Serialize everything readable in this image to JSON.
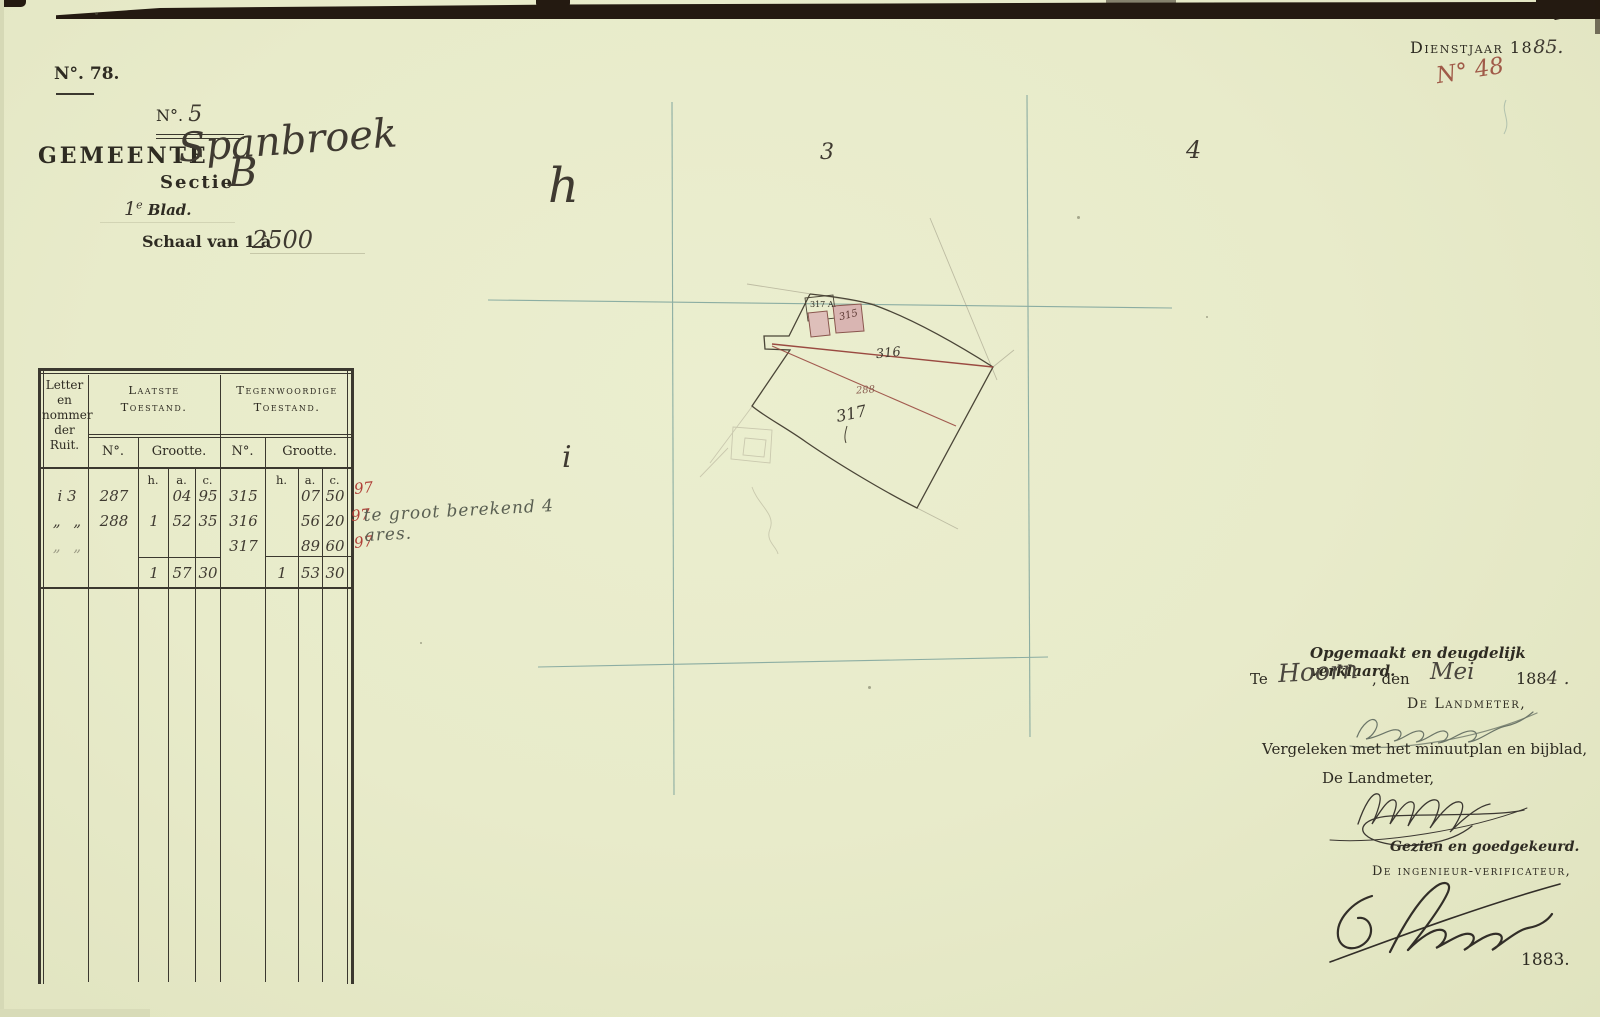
{
  "colors": {
    "paper": "#e8ebca",
    "print": "#2e2b22",
    "ink": "#3b382f",
    "script": "#3f3a31",
    "red": "#b04038",
    "redbrown": "#9a4a41",
    "teal": "#7ba29b",
    "pink": "#dcbab6",
    "edge": "#241a11",
    "sig_grey": "#6b7568",
    "note": "#5a5f52"
  },
  "header": {
    "dossier_number": "N°. 78.",
    "dienstjaar_print": "Dienstjaar 18",
    "dienstjaar_script": "85.",
    "folio_number": "N° 48"
  },
  "title": {
    "no_label": "N°.",
    "no_value": "5",
    "gemeente_label": "GEMEENTE",
    "gemeente_name": "Spanbroek",
    "sectie_label": "Sectie",
    "sectie_value": "B",
    "blad_no": "1",
    "blad_sup": "e",
    "blad_label": "Blad.",
    "schaal_label": "Schaal van 1 à",
    "schaal_value": "2500"
  },
  "table": {
    "corner_header_lines": [
      "Letter",
      "en",
      "nommer",
      "der",
      "Ruit."
    ],
    "group_old": {
      "line1": "Laatste",
      "line2": "Toestand."
    },
    "group_new": {
      "line1": "Tegenwoordige",
      "line2": "Toestand."
    },
    "no_header": "N°.",
    "grootte_header": "Grootte.",
    "hac": [
      "h.",
      "a.",
      "c."
    ],
    "rows": [
      {
        "ruit": "i 3",
        "old_no": "287",
        "old_h": "",
        "old_a": "04",
        "old_c": "95",
        "new_no": "315",
        "new_h": "",
        "new_a": "07",
        "new_c": "50",
        "mark": "97"
      },
      {
        "ruit": "„ „",
        "old_no": "288",
        "old_h": "1",
        "old_a": "52",
        "old_c": "35",
        "new_no": "316",
        "new_h": "",
        "new_a": "56",
        "new_c": "20",
        "mark": "97"
      },
      {
        "ruit": "„ „",
        "old_no": "",
        "old_h": "",
        "old_a": "",
        "old_c": "",
        "new_no": "317",
        "new_h": "",
        "new_a": "89",
        "new_c": "60",
        "mark": "97"
      }
    ],
    "totals": {
      "old_h": "1",
      "old_a": "57",
      "old_c": "30",
      "new_h": "1",
      "new_a": "53",
      "new_c": "30"
    },
    "annotation": "te groot berekend 4 ares."
  },
  "map": {
    "grid_number_3": "3",
    "grid_number_4": "4",
    "grid_letter_h": "h",
    "grid_letter_i": "i",
    "parcel_316": "316",
    "parcel_317": "317",
    "old_parcel_288": "288",
    "building_315": "315",
    "building_317a": "317 A."
  },
  "attestation": {
    "declared_line": "Opgemaakt en deugdelijk verklaard.",
    "te_label": "Te",
    "place": "Hoorn",
    "den_label": ", den",
    "month": "Mei",
    "year_print": "188",
    "year_script": "4 .",
    "landmeter_caps": "De Landmeter,",
    "compare_line": "Vergeleken met het minuutplan en bijblad,",
    "landmeter_plain": "De Landmeter,",
    "approved_line": "Gezien en goedgekeurd.",
    "verificateur_caps": "De ingenieur-verificateur,",
    "year_bottom": "1883."
  }
}
